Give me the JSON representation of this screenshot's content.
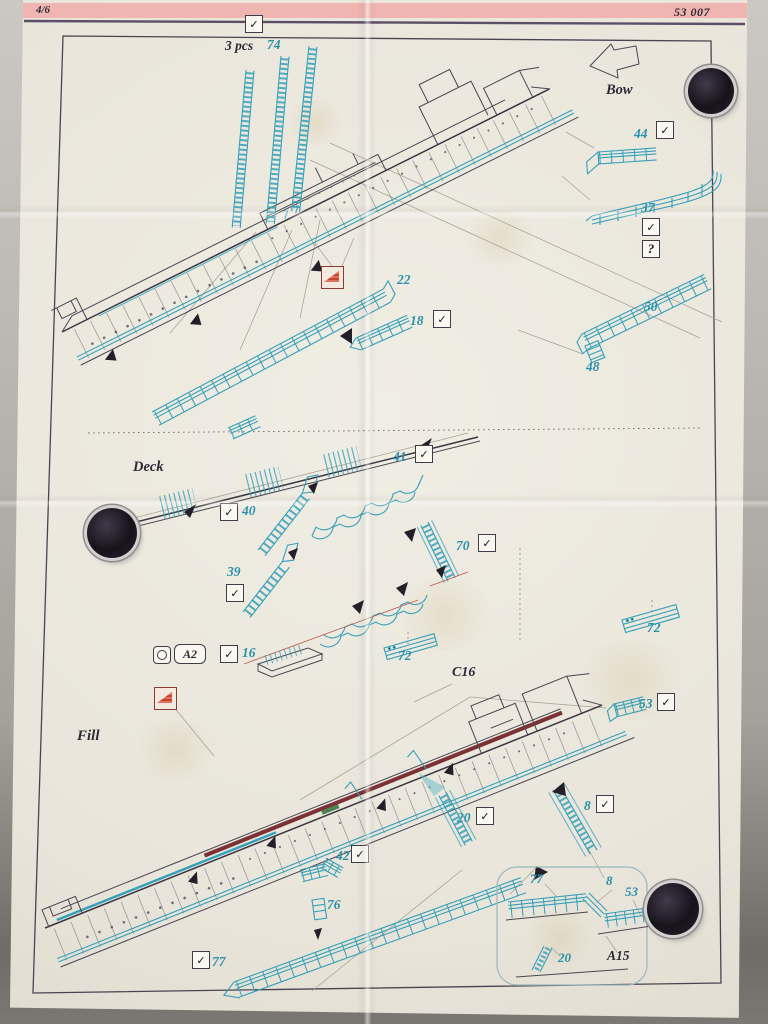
{
  "header": {
    "page_number": "4/6",
    "product_code": "53 007"
  },
  "top_diagram": {
    "quantity_label": "3 pcs",
    "quantity_part": "74",
    "bow_label": "Bow",
    "part_44": "44",
    "part_37": "37",
    "part_22": "22",
    "part_18": "18",
    "part_50": "50",
    "part_48": "48"
  },
  "mid_diagram": {
    "deck_label": "Deck",
    "part_41": "41",
    "part_40": "40",
    "part_70": "70",
    "part_39": "39",
    "part_72_left": "72",
    "part_72_right": "72",
    "fret_label": "A2",
    "part_16": "16",
    "ref_c16": "C16",
    "part_53": "53"
  },
  "bottom_diagram": {
    "fill_label": "Fill",
    "part_20": "20",
    "part_8": "8",
    "part_42": "42",
    "part_76": "76",
    "part_77": "77",
    "inset": {
      "part_77": "77",
      "part_8": "8",
      "part_53": "53",
      "part_20": "20",
      "ref_a15": "A15"
    }
  },
  "symbols": {
    "check": "✓",
    "question": "?"
  },
  "icons": {
    "bow_arrow": "bow-direction-arrow-icon",
    "bend_symbol": "fold-bend-triangle-icon",
    "fret_symbol": "pe-fret-icon",
    "checkbox": "checked-box-icon",
    "magnet": "round-magnet"
  },
  "colors": {
    "teal": "#2a92ac",
    "ink": "#2e2b36",
    "stripe_pink": "#f1b5b1",
    "rule_purple": "#5c4e68",
    "bend_red": "#b23a2c"
  }
}
